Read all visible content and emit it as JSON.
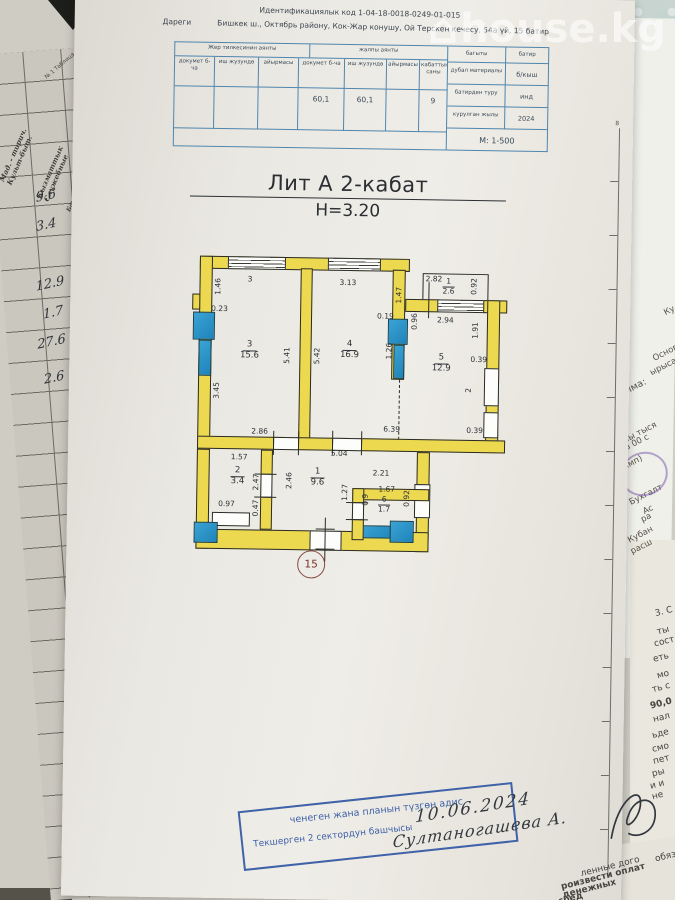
{
  "watermark": {
    "icon": "⌂",
    "text": "house.kg"
  },
  "document": {
    "header": {
      "id_line": "Идентификациялык код 1-04-18-0018-0249-01-015",
      "address_label": "Дареги",
      "address": "Бишкек ш., Октябрь району, Кок-Жар конушу, Ой Терскен кечесу, 54а үй, 15 батир"
    },
    "table": {
      "land_group": "Жер тилкесинин аянты",
      "total_group": "жалпы аянты",
      "col_doc": "докумет б-ча",
      "col_fact": "иш жузундө",
      "col_diff": "айырмасы",
      "col_doc2": "докумет б-ча",
      "col_fact2": "иш жузундө",
      "col_diff2": "айырмасы",
      "col_floors": "кабаттын саны",
      "col_direction": "багыты",
      "col_flat": "батир",
      "total_doc_value": "60,1",
      "total_fact_value": "60,1",
      "floors_value": "9",
      "row_wall_material": "дубал материалы",
      "val_wall_material": "б/кыш",
      "row_flat_type": "батирден туру",
      "val_flat_type": "инд",
      "row_year": "курулган жылы",
      "val_year": "2024",
      "scale": "М: 1-500"
    },
    "title": "Лит А 2-кабат",
    "height_label": "Н=3.20",
    "ruler_mark": "8",
    "plan": {
      "apartment_number": "15",
      "rooms": {
        "r3": {
          "num": "3",
          "area": "15.6"
        },
        "r4": {
          "num": "4",
          "area": "16.9"
        },
        "r5": {
          "num": "5",
          "area": "12.9"
        },
        "bal": {
          "num": "1",
          "area": "2.6"
        },
        "r2": {
          "num": "2",
          "area": "3.4"
        },
        "hall": {
          "num": "1",
          "area": "9.6"
        },
        "wc": {
          "num": "6",
          "area": "1.7"
        }
      },
      "dims": [
        "1.46",
        "0.23",
        "3",
        "3.13",
        "2.82",
        "0.92",
        "1.47",
        "0.19",
        "0.96",
        "2.94",
        "1.91",
        "5.41",
        "5.42",
        "1.26",
        "0.39",
        "2",
        "0.39",
        "3.45",
        "2.86",
        "6.39",
        "1.57",
        "5.04",
        "2.47",
        "2.46",
        "2.21",
        "1.67",
        "1.27",
        "0.9",
        "0.92",
        "0.97",
        "0.47"
      ]
    },
    "stamp": {
      "line1": "ченеген жана планын түзгөн адис",
      "line2": "Текшерген 2 сектордун башчысы"
    },
    "signature": {
      "date": "10.06.2024",
      "name": "Султаногашева А."
    }
  },
  "ledger": {
    "table_no": "№ 1 Таблица",
    "headers": [
      {
        "ky": "Мад. - тирич.",
        "ru": "Культ-быт."
      },
      {
        "ky": "Кызматтык",
        "ru": "Служебные"
      },
      {
        "ky": "Башкалар",
        "ru": "Прочие"
      }
    ],
    "values": [
      "9.6",
      "3.4",
      "12.9",
      "1.7",
      "27.6",
      "2.6"
    ]
  },
  "side_papers": {
    "upper": [
      "Ку",
      "Основ",
      "ырыса",
      "Сумма:",
      "SD",
      "мы тыся",
      "ров 00 с",
      "тамп)",
      "Бухгалт",
      "Ас",
      "ра",
      "Кубан",
      "расш"
    ],
    "lower": [
      "3. С",
      "ты",
      "сост",
      "еть",
      "мо",
      "ть с",
      "90,0",
      "нал",
      "ьде",
      "смо",
      "пет",
      "ры",
      "и и",
      "не",
      "обяз",
      "ленные дого",
      "роизвести оплат",
      "денежных",
      "сред"
    ]
  }
}
